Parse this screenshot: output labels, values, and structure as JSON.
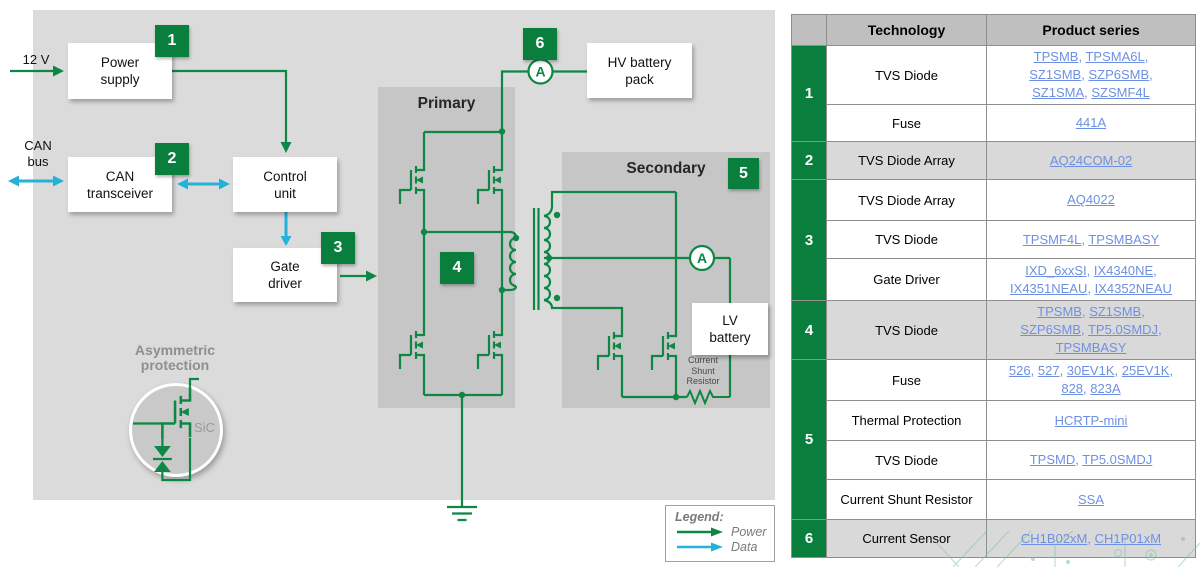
{
  "colors": {
    "green": "#0a7e3c",
    "wire_green": "#0d8743",
    "cyan": "#25b2d9",
    "link_blue": "#6e90e3",
    "panel_gray": "#dbdbdb",
    "section_gray": "#c6c6c6",
    "header_gray": "#bfbfbf",
    "row_shade_gray": "#d9d9d9"
  },
  "diagram": {
    "v12_label": "12 V",
    "can_bus_label": [
      "CAN",
      "bus"
    ],
    "boxes": {
      "power_supply": [
        "Power",
        "supply"
      ],
      "can_transceiver": [
        "CAN",
        "transceiver"
      ],
      "control_unit": [
        "Control",
        "unit"
      ],
      "gate_driver": [
        "Gate",
        "driver"
      ],
      "hv_battery": [
        "HV battery",
        "pack"
      ],
      "lv_battery": [
        "LV",
        "battery"
      ]
    },
    "primary_label": "Primary",
    "secondary_label": "Secondary",
    "badges": [
      "1",
      "2",
      "3",
      "4",
      "5",
      "6"
    ],
    "ammeter_label": "A",
    "asymmetric_label": [
      "Asymmetric",
      "protection"
    ],
    "sic_label": "SiC",
    "shunt_label": [
      "Current",
      "Shunt",
      "Resistor"
    ],
    "legend": {
      "title": "Legend:",
      "power": "Power",
      "data": "Data"
    }
  },
  "table": {
    "headers": {
      "tech": "Technology",
      "product": "Product series"
    },
    "groups": [
      {
        "num": "1",
        "rows": [
          {
            "tech": "TVS Diode",
            "links": [
              "TPSMB",
              "TPSMA6L",
              "SZ1SMB",
              "SZP6SMB",
              "SZ1SMA",
              "SZSMF4L"
            ]
          },
          {
            "tech": "Fuse",
            "links": [
              "441A"
            ]
          }
        ]
      },
      {
        "num": "2",
        "rows": [
          {
            "tech": "TVS Diode Array",
            "links": [
              "AQ24COM-02"
            ]
          }
        ]
      },
      {
        "num": "3",
        "rows": [
          {
            "tech": "TVS Diode Array",
            "links": [
              "AQ4022"
            ]
          },
          {
            "tech": "TVS Diode",
            "links": [
              "TPSMF4L",
              "TPSMBASY"
            ]
          },
          {
            "tech": "Gate Driver",
            "links": [
              "IXD_6xxSI",
              "IX4340NE",
              "IX4351NEAU",
              "IX4352NEAU"
            ]
          }
        ]
      },
      {
        "num": "4",
        "rows": [
          {
            "tech": "TVS Diode",
            "links": [
              "TPSMB",
              "SZ1SMB",
              "SZP6SMB",
              "TP5.0SMDJ",
              "TPSMBASY"
            ]
          }
        ]
      },
      {
        "num": "5",
        "rows": [
          {
            "tech": "Fuse",
            "links": [
              "526",
              "527",
              "30EV1K",
              "25EV1K",
              "828",
              "823A"
            ]
          },
          {
            "tech": "Thermal Protection",
            "links": [
              "HCRTP-mini"
            ]
          },
          {
            "tech": "TVS Diode",
            "links": [
              "TPSMD",
              "TP5.0SMDJ"
            ]
          },
          {
            "tech": "Current Shunt Resistor",
            "links": [
              "SSA"
            ]
          }
        ]
      },
      {
        "num": "6",
        "rows": [
          {
            "tech": "Current Sensor",
            "links": [
              "CH1B02xM",
              "CH1P01xM"
            ]
          }
        ]
      }
    ]
  }
}
